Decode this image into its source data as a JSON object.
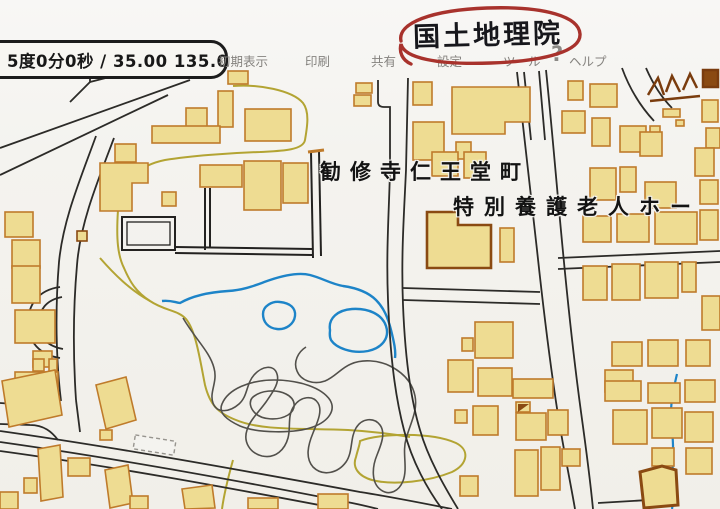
{
  "window": {
    "coordinate_readout": "5度0分0秒 / 35.00 135.0"
  },
  "toolbar": {
    "items": [
      {
        "label": "初期表示"
      },
      {
        "label": "印刷"
      },
      {
        "label": "共有"
      },
      {
        "label": "設定"
      },
      {
        "label": "ツール"
      },
      {
        "label": "ヘルプ"
      }
    ],
    "help_icon": "?"
  },
  "annotation": {
    "handwritten_title": "国土地理院"
  },
  "map": {
    "labels": {
      "town": "勧修寺仁王堂町",
      "facility": "特別養護老人ホー"
    }
  },
  "colors": {
    "paper": "#f4f3ef",
    "building_fill": "#eedc92",
    "building_stroke": "#bf7b2b",
    "building_stroke_dark": "#8a4a12",
    "road": "#2c2b28",
    "contour": "#52504b",
    "path_yellow": "#b3a433",
    "water_blue": "#1d84c8",
    "annotation_red": "#a8322c",
    "toolbar_text": "#85837f"
  }
}
